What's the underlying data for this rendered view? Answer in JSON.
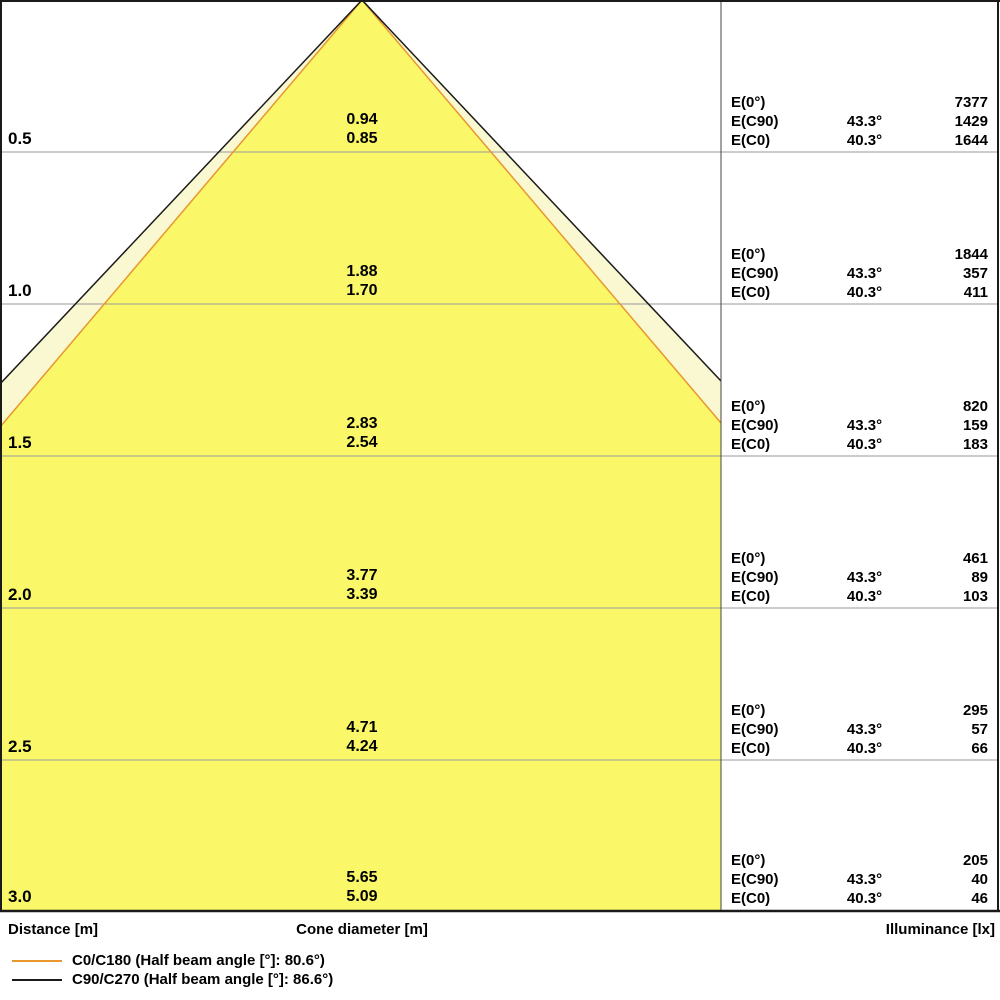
{
  "diagram": {
    "colors": {
      "cone_fill_c0": "#FAF869",
      "cone_fill_c90": "#FAF8D0",
      "c0_line": "#E8962E",
      "c90_line": "#1a1a1a",
      "grid_line": "#999999",
      "border": "#1a1a1a"
    },
    "columns": {
      "distance": "Distance [m]",
      "cone_diameter": "Cone diameter [m]",
      "illuminance": "Illuminance [lx]"
    },
    "e_labels": {
      "e0": "E(0°)",
      "ec90": "E(C90)",
      "ec0": "E(C0)"
    },
    "legend": [
      {
        "label": "C0/C180 (Half beam angle [°]: 80.6°)",
        "color": "#E8962E"
      },
      {
        "label": "C90/C270 (Half beam angle [°]: 86.6°)",
        "color": "#1a1a1a"
      }
    ],
    "rows": [
      {
        "distance": "0.5",
        "cone_c90": "0.94",
        "cone_c0": "0.85",
        "e0": "7377",
        "angle_c90": "43.3°",
        "e_c90": "1429",
        "angle_c0": "40.3°",
        "e_c0": "1644"
      },
      {
        "distance": "1.0",
        "cone_c90": "1.88",
        "cone_c0": "1.70",
        "e0": "1844",
        "angle_c90": "43.3°",
        "e_c90": "357",
        "angle_c0": "40.3°",
        "e_c0": "411"
      },
      {
        "distance": "1.5",
        "cone_c90": "2.83",
        "cone_c0": "2.54",
        "e0": "820",
        "angle_c90": "43.3°",
        "e_c90": "159",
        "angle_c0": "40.3°",
        "e_c0": "183"
      },
      {
        "distance": "2.0",
        "cone_c90": "3.77",
        "cone_c0": "3.39",
        "e0": "461",
        "angle_c90": "43.3°",
        "e_c90": "89",
        "angle_c0": "40.3°",
        "e_c0": "103"
      },
      {
        "distance": "2.5",
        "cone_c90": "4.71",
        "cone_c0": "4.24",
        "e0": "295",
        "angle_c90": "43.3°",
        "e_c90": "57",
        "angle_c0": "40.3°",
        "e_c0": "66"
      },
      {
        "distance": "3.0",
        "cone_c90": "5.65",
        "cone_c0": "5.09",
        "e0": "205",
        "angle_c90": "43.3°",
        "e_c90": "40",
        "angle_c0": "40.3°",
        "e_c0": "46"
      }
    ]
  },
  "chart_data": [
    {
      "type": "area",
      "title": "Luminous cone diagram",
      "xlabel": "Cone diameter [m]",
      "ylabel": "Distance [m]",
      "ylim": [
        0,
        3.0
      ],
      "grid": true,
      "legend_position": "bottom-left",
      "distances_m": [
        0.5,
        1.0,
        1.5,
        2.0,
        2.5,
        3.0
      ],
      "series": [
        {
          "name": "C0/C180 (Half beam angle [°]: 80.6°)",
          "half_beam_angle_deg": 80.6,
          "cone_diameter_m": [
            0.85,
            1.7,
            2.54,
            3.39,
            4.24,
            5.09
          ]
        },
        {
          "name": "C90/C270 (Half beam angle [°]: 86.6°)",
          "half_beam_angle_deg": 86.6,
          "cone_diameter_m": [
            0.94,
            1.88,
            2.83,
            3.77,
            4.71,
            5.65
          ]
        }
      ]
    },
    {
      "type": "table",
      "title": "Illuminance [lx]",
      "columns": [
        "Distance [m]",
        "E(0°)",
        "E(C90) angle",
        "E(C90)",
        "E(C0) angle",
        "E(C0)"
      ],
      "rows": [
        [
          0.5,
          7377,
          "43.3°",
          1429,
          "40.3°",
          1644
        ],
        [
          1.0,
          1844,
          "43.3°",
          357,
          "40.3°",
          411
        ],
        [
          1.5,
          820,
          "43.3°",
          159,
          "40.3°",
          183
        ],
        [
          2.0,
          461,
          "43.3°",
          89,
          "40.3°",
          103
        ],
        [
          2.5,
          295,
          "43.3°",
          57,
          "40.3°",
          66
        ],
        [
          3.0,
          205,
          "43.3°",
          40,
          "40.3°",
          46
        ]
      ]
    }
  ]
}
